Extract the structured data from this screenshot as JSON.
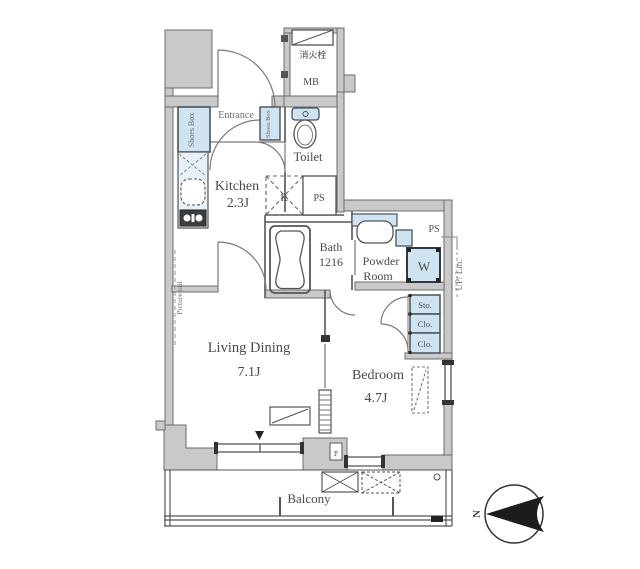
{
  "colors": {
    "wall_fill": "#c9c9c9",
    "wall_stroke": "#6b6b6b",
    "line": "#4f4f4f",
    "fixture_fill": "#cfe4f0",
    "fixture_stroke": "#47525c",
    "text": "#4a4a4a",
    "compass": "#1c1c1c"
  },
  "rooms": {
    "entrance": {
      "label": "Entrance"
    },
    "kitchen": {
      "label": "Kitchen",
      "size": "2.3J"
    },
    "toilet": {
      "label": "Toilet"
    },
    "bath": {
      "label": "Bath",
      "size": "1216"
    },
    "powder_room": {
      "line1": "Powder",
      "line2": "Room"
    },
    "living_dining": {
      "label": "Living Dining",
      "size": "7.1J"
    },
    "bedroom": {
      "label": "Bedroom",
      "size": "4.7J"
    },
    "balcony": {
      "label": "Balcony"
    }
  },
  "fixtures": {
    "shoes_box": "Shoes Box",
    "shoes_box_small": "Shoes Box",
    "fire_hydrant": "消火栓",
    "meter_box": "MB",
    "pipe_space_top": "PS",
    "pipe_space_right": "PS",
    "refrigerator": "R",
    "washing_machine": "W",
    "pipe": "P",
    "storage": "Sto.",
    "closet1": "Clo.",
    "closet2": "Clo.",
    "up_linen": "UP/ Lin.",
    "picture_rail": "Picture rail",
    "north": "N"
  }
}
